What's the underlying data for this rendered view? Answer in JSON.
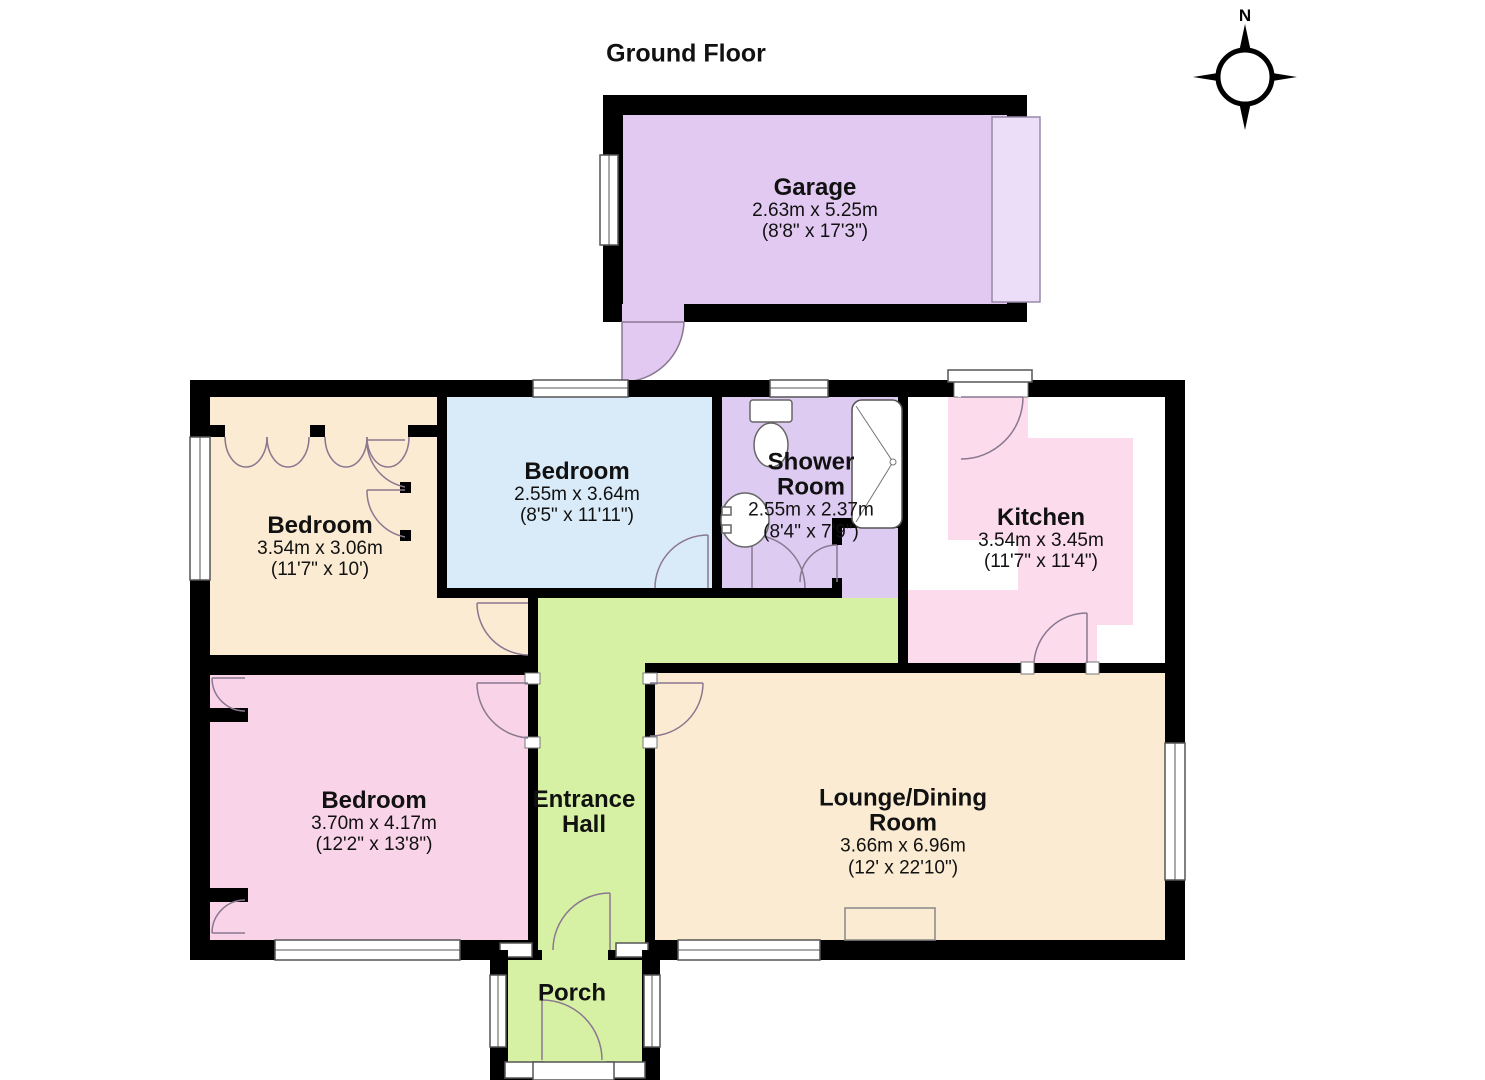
{
  "title": "Ground Floor",
  "compass": {
    "label": "N"
  },
  "rooms": [
    {
      "id": "garage",
      "name": "Garage",
      "metric": "2.63m x 5.25m",
      "imperial": "(8'8\" x 17'3\")"
    },
    {
      "id": "bedroom-1",
      "name": "Bedroom",
      "metric": "3.54m x 3.06m",
      "imperial": "(11'7\" x 10')"
    },
    {
      "id": "bedroom-2",
      "name": "Bedroom",
      "metric": "2.55m x 3.64m",
      "imperial": "(8'5\" x 11'11\")"
    },
    {
      "id": "shower-room",
      "name": "Shower Room",
      "metric": "2.55m x 2.37m",
      "imperial": "(8'4\" x 7'9\")"
    },
    {
      "id": "kitchen",
      "name": "Kitchen",
      "metric": "3.54m x 3.45m",
      "imperial": "(11'7\" x 11'4\")"
    },
    {
      "id": "bedroom-3",
      "name": "Bedroom",
      "metric": "3.70m x 4.17m",
      "imperial": "(12'2\" x 13'8\")"
    },
    {
      "id": "lounge-dining",
      "name": "Lounge/Dining Room",
      "metric": "3.66m x 6.96m",
      "imperial": "(12' x 22'10\")"
    },
    {
      "id": "entrance-hall",
      "name": "Entrance Hall",
      "metric": "",
      "imperial": ""
    },
    {
      "id": "porch",
      "name": "Porch",
      "metric": "",
      "imperial": ""
    }
  ],
  "colors": {
    "wall": "#000000",
    "garage_fill": "#e2c9f2",
    "garage_door_strip": "#ecddf8",
    "shower_fill": "#decbf2",
    "bedroom_blue_fill": "#d9eaf8",
    "wheat_fill": "#faebd2",
    "bedroom_pink_fill": "#f9d4e8",
    "kitchen_fill": "#fbdbec",
    "hall_green_fill": "#d7f1a4",
    "door_arc": "#8a7890",
    "window_frame": "#555555"
  }
}
